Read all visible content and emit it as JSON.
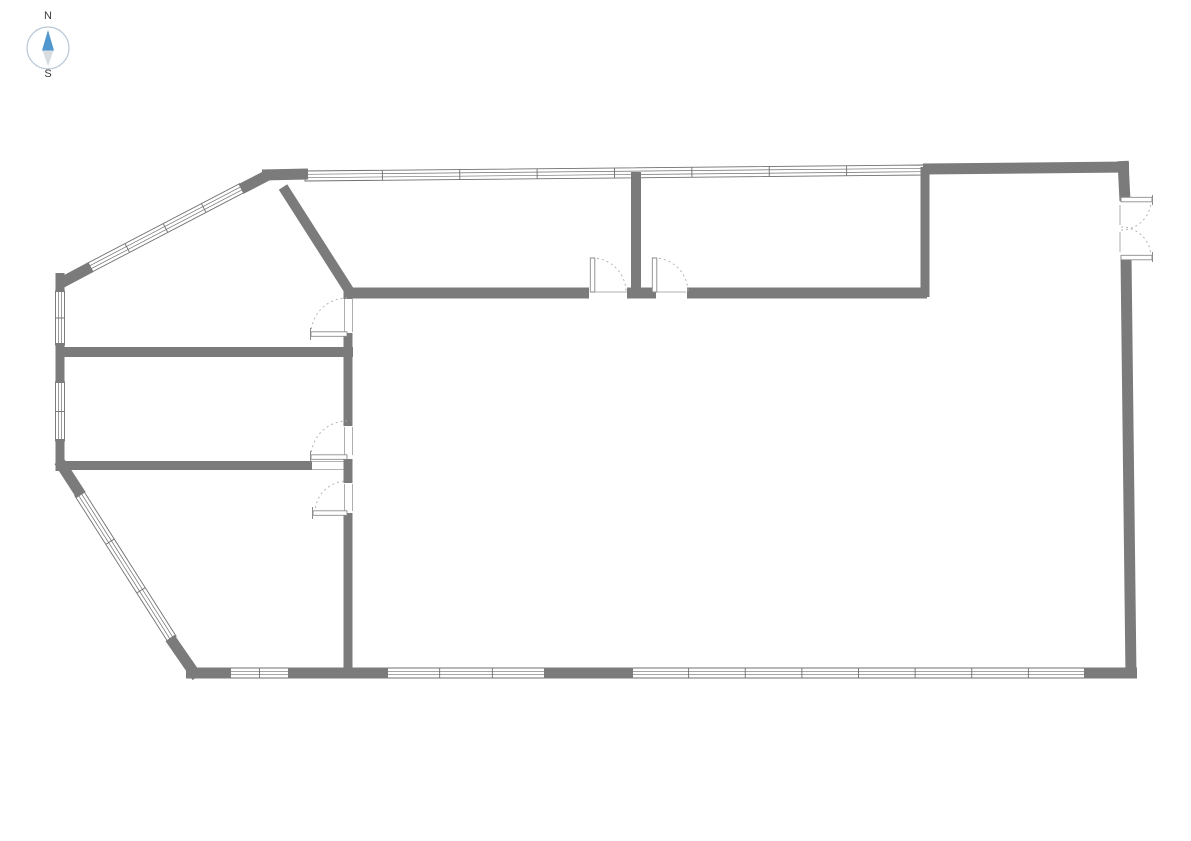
{
  "page": {
    "background": "#ffffff"
  },
  "compass": {
    "north_label": "N",
    "south_label": "S",
    "circle": {
      "cx": 48,
      "cy": 48,
      "r": 21,
      "stroke": "#b7c7d7",
      "fill": "#ffffff"
    },
    "arrows": [
      {
        "name": "compass-north-arrow",
        "points": "48,30 42,50.5 54,50.5",
        "color": "#4f97cc"
      },
      {
        "name": "compass-south-arrow",
        "points": "42.5,50.5 53.5,50.5 48,66",
        "color": "#d9dde1"
      }
    ]
  },
  "floor_plan": {
    "colors": {
      "wall": "#7b7b7b",
      "outline": "#6f6f6f",
      "thin": "#9a9a9a",
      "arc": "#b5b5b5",
      "leaf": "#8a8a8a"
    },
    "walls": [
      [
        262,
        175,
        308,
        174,
        11
      ],
      [
        923,
        169,
        1129,
        167,
        11
      ],
      [
        1123,
        161,
        1125,
        201,
        11
      ],
      [
        1126,
        256,
        1131,
        677,
        11
      ],
      [
        186,
        673,
        231,
        673,
        11
      ],
      [
        288,
        673,
        388,
        673,
        11
      ],
      [
        544,
        673,
        633,
        673,
        11
      ],
      [
        1084,
        673,
        1137,
        673,
        11
      ],
      [
        60,
        273,
        60,
        292,
        9
      ],
      [
        60,
        343,
        60,
        383,
        9
      ],
      [
        60,
        439,
        60,
        471,
        9
      ],
      [
        59,
        284,
        91,
        267,
        11
      ],
      [
        241,
        189,
        270,
        174,
        11
      ],
      [
        59,
        461,
        81,
        495,
        11
      ],
      [
        170,
        638,
        197,
        677,
        11
      ],
      [
        283,
        187,
        350,
        292,
        10
      ],
      [
        344,
        293,
        589,
        293,
        11
      ],
      [
        627,
        293,
        656,
        293,
        11
      ],
      [
        687,
        293,
        927,
        293,
        11
      ],
      [
        636,
        172,
        636,
        294,
        10
      ],
      [
        925,
        167,
        925,
        297,
        9
      ],
      [
        58,
        352,
        353,
        352,
        10
      ],
      [
        348,
        287,
        348,
        299,
        9
      ],
      [
        348,
        333,
        348,
        426,
        9
      ],
      [
        348,
        459,
        348,
        483,
        9
      ],
      [
        348,
        513,
        348,
        678,
        9
      ],
      [
        56,
        465.5,
        312,
        465.5,
        9
      ]
    ],
    "windows": [
      [
        89,
        268,
        242,
        188,
        10,
        3
      ],
      [
        305,
        176,
        924,
        170,
        10,
        7
      ],
      [
        60,
        291,
        60,
        345,
        9,
        1
      ],
      [
        60,
        382,
        60,
        441,
        9,
        1
      ],
      [
        79,
        493,
        172,
        639,
        10,
        2
      ],
      [
        230,
        673,
        289,
        673,
        10,
        1
      ],
      [
        387,
        673,
        545,
        673,
        10,
        2
      ],
      [
        632,
        673,
        1085,
        673,
        10,
        7
      ]
    ],
    "doors": [
      {
        "leaf": [
          592.5,
          258,
          592.5,
          292
        ],
        "tick": null,
        "arc": [
          592,
          292,
          34,
          270,
          360,
          1
        ]
      },
      {
        "leaf": [
          654.5,
          258,
          654.5,
          292
        ],
        "tick": null,
        "arc": [
          654,
          292,
          34,
          270,
          360,
          1
        ]
      },
      {
        "leaf": [
          311,
          334,
          347,
          334
        ],
        "tick": [
          310.5,
          328,
          310.5,
          340
        ],
        "arc": [
          347,
          334,
          36,
          180,
          270,
          1
        ]
      },
      {
        "leaf": [
          311,
          457,
          347,
          457
        ],
        "tick": [
          310.5,
          451,
          310.5,
          463
        ],
        "arc": [
          347,
          457,
          36,
          180,
          270,
          1
        ]
      },
      {
        "leaf": [
          313,
          513,
          347,
          513
        ],
        "tick": [
          312.5,
          507,
          312.5,
          519
        ],
        "arc": [
          347,
          513,
          32,
          180,
          270,
          1
        ]
      },
      {
        "leaf": [
          1121,
          199.5,
          1152,
          199.5
        ],
        "tick": [
          1152.5,
          195,
          1152.5,
          205
        ],
        "arc": [
          1121,
          200,
          30,
          0,
          90,
          1
        ]
      },
      {
        "leaf": [
          1121,
          257.5,
          1152,
          257.5
        ],
        "tick": [
          1152.5,
          252,
          1152.5,
          262
        ],
        "arc": [
          1121,
          257,
          30,
          0,
          270,
          0
        ]
      }
    ],
    "jamb_lines": [
      [
        593,
        292,
        627,
        292
      ],
      [
        657,
        292,
        686,
        292
      ],
      [
        344.5,
        299,
        344.5,
        332
      ],
      [
        352.5,
        299,
        352.5,
        332
      ],
      [
        344.5,
        427,
        344.5,
        455
      ],
      [
        352.5,
        427,
        352.5,
        455
      ],
      [
        344.5,
        484,
        344.5,
        511
      ],
      [
        352.5,
        484,
        352.5,
        511
      ],
      [
        1120,
        205,
        1120,
        225
      ],
      [
        1120,
        232,
        1120,
        252
      ],
      [
        312,
        461.5,
        344,
        461.5
      ],
      [
        312,
        469.5,
        344,
        469.5
      ]
    ]
  }
}
